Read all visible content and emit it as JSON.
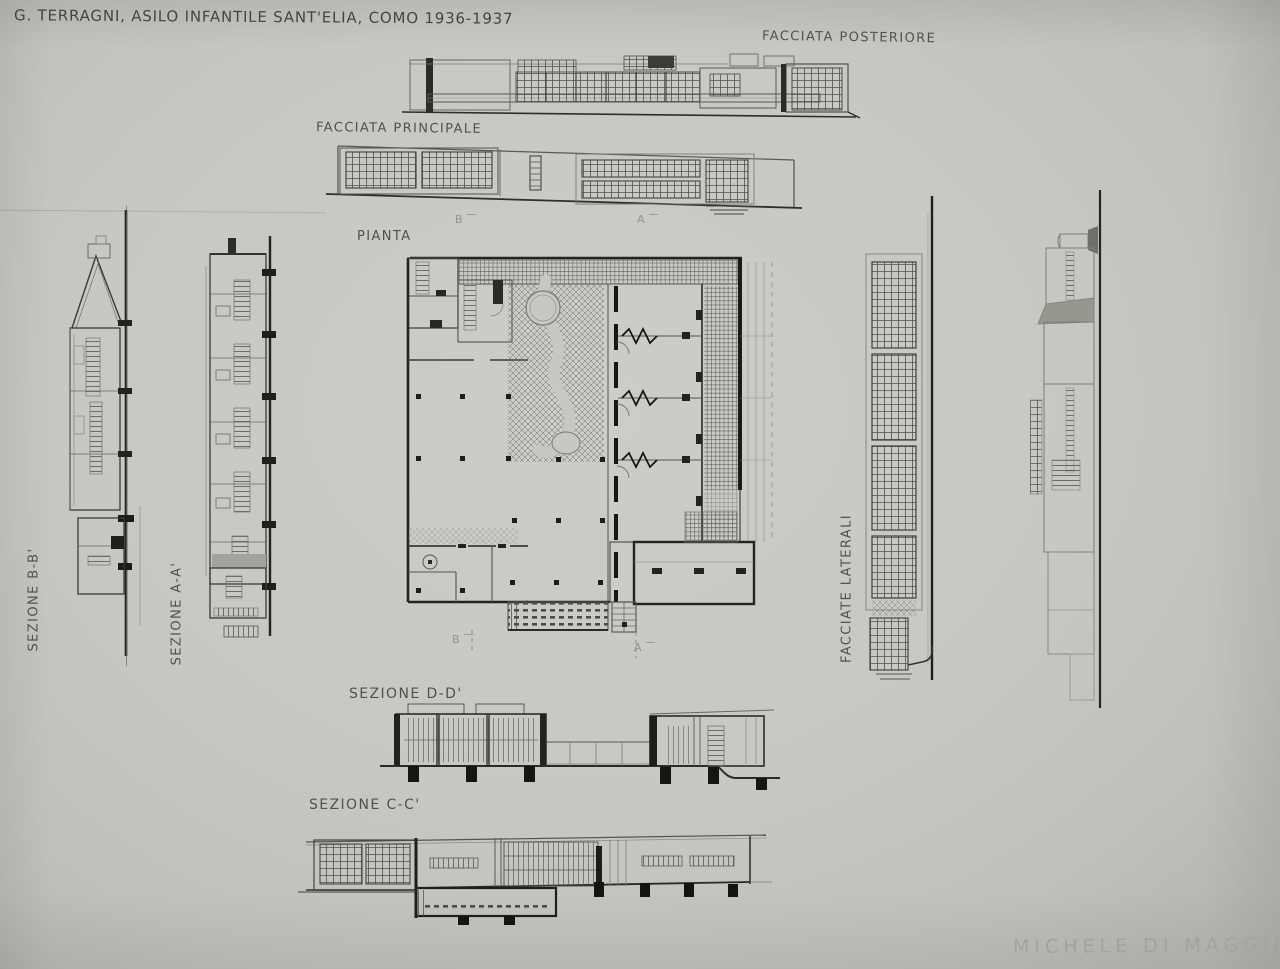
{
  "page": {
    "title": "G. TERRAGNI, ASILO INFANTILE SANT'ELIA, COMO 1936-1937",
    "signature": "MICHELE DI MAGGIO"
  },
  "labels": {
    "facciata_posteriore": "FACCIATA POSTERIORE",
    "facciata_principale": "FACCIATA PRINCIPALE",
    "pianta": "PIANTA",
    "sezione_bb": "SEZIONE B-B'",
    "sezione_aa": "SEZIONE A-A'",
    "facciate_laterali": "FACCIATE LATERALI",
    "sezione_dd": "SEZIONE D-D'",
    "sezione_cc": "SEZIONE C-C'"
  },
  "section_markers": {
    "top_b": "B",
    "top_a": "A",
    "bottom_b": "B",
    "bottom_a": "A"
  },
  "colors": {
    "paper": "#c8c7c3",
    "pencil_dark": "#2e2e2c",
    "pencil_medium": "#55544f",
    "pencil_light": "#8a8984",
    "signature": "#a3a29e"
  }
}
